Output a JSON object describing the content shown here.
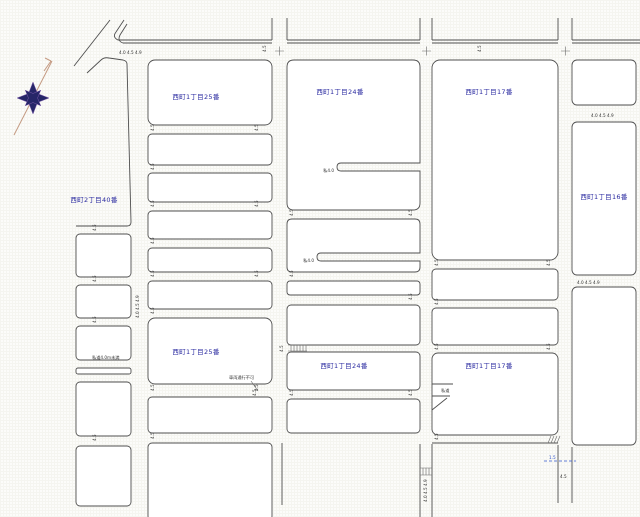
{
  "map": {
    "colors": {
      "background": "#fcfcfa",
      "line": "#4f4f4f",
      "block_label": "#2a2aa0",
      "annotation": "#333333",
      "dash_marker": "#3355cc",
      "compass_star": "#262668",
      "compass_needle": "#c49a82"
    },
    "compass": {
      "icon": "compass-rose-icon"
    },
    "block_labels": [
      {
        "text": "西町1丁目25番",
        "x": 196,
        "y": 99
      },
      {
        "text": "西町1丁目24番",
        "x": 340,
        "y": 94
      },
      {
        "text": "西町1丁目17番",
        "x": 489,
        "y": 94
      },
      {
        "text": "西町2丁目40番",
        "x": 94,
        "y": 202
      },
      {
        "text": "西町1丁目16番",
        "x": 604,
        "y": 199
      },
      {
        "text": "西町1丁目25番",
        "x": 196,
        "y": 354
      },
      {
        "text": "西町1丁目24番",
        "x": 344,
        "y": 368
      },
      {
        "text": "西町1丁目17番",
        "x": 489,
        "y": 368
      }
    ],
    "annotations": [
      {
        "text": "4.0 4.5 4.9",
        "x": 119,
        "y": 54
      },
      {
        "text": "4.5",
        "x": 266,
        "y": 52,
        "rot": -90
      },
      {
        "text": "4.5",
        "x": 481,
        "y": 52,
        "rot": -90
      },
      {
        "text": "私4.0",
        "x": 334,
        "y": 172,
        "anchor": "end"
      },
      {
        "text": "私4.0",
        "x": 314,
        "y": 262,
        "anchor": "end"
      },
      {
        "text": "車両通行不可",
        "x": 229,
        "y": 379
      },
      {
        "text": "4.5",
        "x": 256,
        "y": 396,
        "rot": -90
      },
      {
        "text": "私道",
        "x": 441,
        "y": 392
      },
      {
        "text": "私道4.0m未満",
        "x": 92,
        "y": 359
      },
      {
        "text": "4.0 4.5 4.9",
        "x": 577,
        "y": 284
      },
      {
        "text": "4.0 4.5 4.9",
        "x": 591,
        "y": 117
      },
      {
        "text": "4.0 4.5 4.9",
        "x": 427,
        "y": 502,
        "rot": -90
      },
      {
        "text": "4.0 4.5 4.9",
        "x": 139,
        "y": 318,
        "rot": -90
      },
      {
        "text": "1.5",
        "x": 549,
        "y": 459,
        "color": "#3355cc"
      },
      {
        "text": "4.5",
        "x": 560,
        "y": 478
      },
      {
        "text": "4.5",
        "x": 283,
        "y": 352,
        "rot": -90
      },
      {
        "text": "4.5",
        "x": 154,
        "y": 131,
        "rot": -90
      },
      {
        "text": "4.5",
        "x": 154,
        "y": 170,
        "rot": -90
      },
      {
        "text": "4.5",
        "x": 154,
        "y": 207,
        "rot": -90
      },
      {
        "text": "4.5",
        "x": 154,
        "y": 244,
        "rot": -90
      },
      {
        "text": "4.5",
        "x": 154,
        "y": 277,
        "rot": -90
      },
      {
        "text": "4.5",
        "x": 154,
        "y": 314,
        "rot": -90
      },
      {
        "text": "4.5",
        "x": 154,
        "y": 391,
        "rot": -90
      },
      {
        "text": "4.5",
        "x": 154,
        "y": 439,
        "rot": -90
      },
      {
        "text": "4.5",
        "x": 258,
        "y": 131,
        "rot": -90
      },
      {
        "text": "4.5",
        "x": 258,
        "y": 207,
        "rot": -90
      },
      {
        "text": "4.5",
        "x": 258,
        "y": 277,
        "rot": -90
      },
      {
        "text": "4.5",
        "x": 258,
        "y": 391,
        "rot": -90
      },
      {
        "text": "4.5",
        "x": 293,
        "y": 216,
        "rot": -90
      },
      {
        "text": "4.5",
        "x": 293,
        "y": 277,
        "rot": -90
      },
      {
        "text": "4.5",
        "x": 293,
        "y": 396,
        "rot": -90
      },
      {
        "text": "4.5",
        "x": 412,
        "y": 216,
        "rot": -90
      },
      {
        "text": "4.5",
        "x": 412,
        "y": 300,
        "rot": -90
      },
      {
        "text": "4.5",
        "x": 412,
        "y": 396,
        "rot": -90
      },
      {
        "text": "4.5",
        "x": 438,
        "y": 266,
        "rot": -90
      },
      {
        "text": "4.5",
        "x": 438,
        "y": 305,
        "rot": -90
      },
      {
        "text": "4.5",
        "x": 438,
        "y": 350,
        "rot": -90
      },
      {
        "text": "4.5",
        "x": 438,
        "y": 440,
        "rot": -90
      },
      {
        "text": "4.5",
        "x": 550,
        "y": 266,
        "rot": -90
      },
      {
        "text": "4.5",
        "x": 550,
        "y": 350,
        "rot": -90
      },
      {
        "text": "4.5",
        "x": 96,
        "y": 231,
        "rot": -90
      },
      {
        "text": "4.5",
        "x": 96,
        "y": 282,
        "rot": -90
      },
      {
        "text": "4.5",
        "x": 96,
        "y": 323,
        "rot": -90
      },
      {
        "text": "4.5",
        "x": 96,
        "y": 441,
        "rot": -90
      }
    ]
  }
}
